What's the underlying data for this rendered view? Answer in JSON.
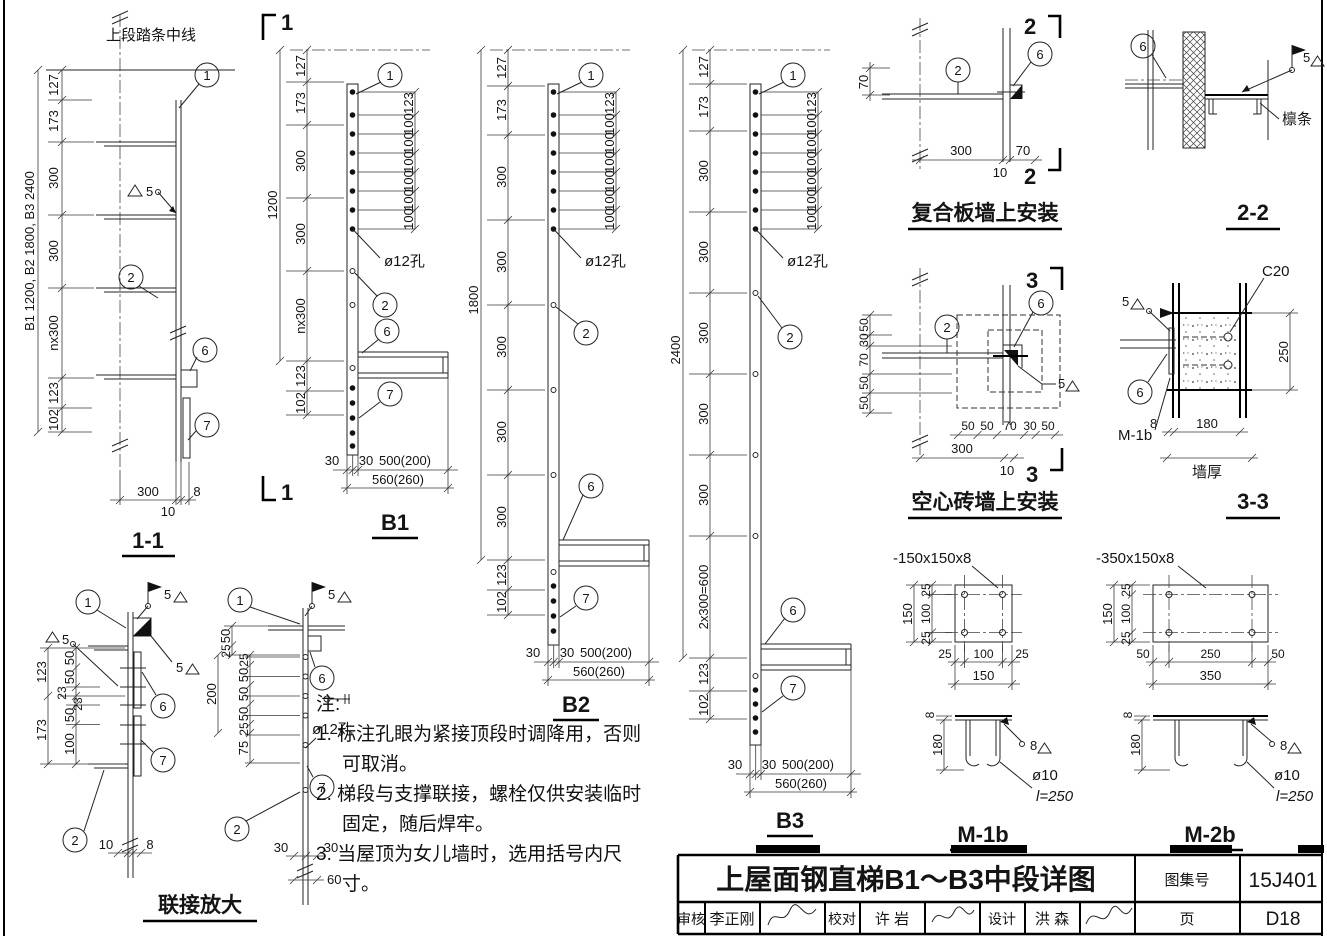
{
  "elevation": {
    "title": "1-1",
    "top_label": "上段踏条中线",
    "side_label": "B1 1200, B2 1800, B3 2400",
    "dims_left": [
      "127",
      "173",
      "300",
      "300",
      "nx300",
      "123",
      "102"
    ],
    "dims_bottom": [
      "300",
      "10",
      "8"
    ],
    "weld": "5",
    "callouts": {
      "c1": "1",
      "c2": "2",
      "c6": "6",
      "c7": "7"
    }
  },
  "b1": {
    "title": "B1",
    "cut_label": "1",
    "overall": "1200",
    "dims_left": [
      "127",
      "173",
      "300",
      "300",
      "nx300",
      "123",
      "102"
    ],
    "dims_right": [
      "123",
      "100",
      "100",
      "100",
      "100",
      "100",
      "100"
    ],
    "hole_label": "ø12孔",
    "dims_bottom": [
      "30",
      "30",
      "500(200)"
    ],
    "dim_total": "560(260)",
    "callouts": {
      "c1": "1",
      "c2": "2",
      "c6": "6",
      "c7": "7"
    }
  },
  "b2": {
    "title": "B2",
    "overall": "1800",
    "dims_left": [
      "127",
      "173",
      "300",
      "300",
      "300",
      "300",
      "300",
      "123",
      "102"
    ],
    "dims_right": [
      "123",
      "100",
      "100",
      "100",
      "100",
      "100",
      "100"
    ],
    "hole_label": "ø12孔",
    "dims_bottom": [
      "30",
      "30",
      "500(200)"
    ],
    "dim_total": "560(260)",
    "callouts": {
      "c1": "1",
      "c2": "2",
      "c6": "6",
      "c7": "7"
    }
  },
  "b3": {
    "title": "B3",
    "overall": "2400",
    "dims_left": [
      "127",
      "173",
      "300",
      "300",
      "300",
      "300",
      "300",
      "2x300=600",
      "123",
      "102"
    ],
    "dims_right": [
      "123",
      "100",
      "100",
      "100",
      "100",
      "100",
      "100"
    ],
    "hole_label": "ø12孔",
    "dims_bottom": [
      "30",
      "30",
      "500(200)"
    ],
    "dim_total": "560(260)",
    "callouts": {
      "c1": "1",
      "c2": "2",
      "c6": "6",
      "c7": "7"
    }
  },
  "composite": {
    "title": "复合板墙上安装",
    "cut_label": "2",
    "dim_offset": "70",
    "dims_bottom": [
      "300",
      "10",
      "70"
    ],
    "callouts": {
      "c2": "2",
      "c6": "6"
    }
  },
  "sec22": {
    "title": "2-2",
    "purlin_label": "檩条",
    "weld": "5",
    "callouts": {
      "c6": "6"
    }
  },
  "hollow": {
    "title": "空心砖墙上安装",
    "cut_label": "3",
    "dims_left": [
      "50",
      "30",
      "70",
      "50",
      "50"
    ],
    "dims_bottom": [
      "50",
      "50",
      "70",
      "30",
      "50"
    ],
    "dim_300": "300",
    "dim_10": "10",
    "weld": "5",
    "callouts": {
      "c2": "2",
      "c6": "6"
    }
  },
  "sec33": {
    "title": "3-3",
    "concrete_label": "C20",
    "dim_depth": "250",
    "bracket_label": "M-1b",
    "dim_plate": "8",
    "dim_wall": "180",
    "wall_label": "墙厚",
    "weld": "5",
    "callouts": {
      "c6": "6"
    }
  },
  "m1b": {
    "title": "M-1b",
    "plate_label": "-150x150x8",
    "dims_side": [
      "25",
      "100",
      "25"
    ],
    "dim_side_total": "150",
    "dims_bottom": [
      "25",
      "100",
      "25"
    ],
    "dim_bottom_total": "150",
    "dim_thickness": "8",
    "dim_embed": "180",
    "weld": "8",
    "anchor_dia": "ø10",
    "anchor_len": "l=250"
  },
  "m2b": {
    "title": "M-2b",
    "plate_label": "-350x150x8",
    "dims_side": [
      "25",
      "100",
      "25"
    ],
    "dim_side_total": "150",
    "dims_bottom": [
      "50",
      "250",
      "50"
    ],
    "dim_bottom_total": "350",
    "dim_thickness": "8",
    "dim_embed": "180",
    "weld": "8",
    "anchor_dia": "ø10",
    "anchor_len": "l=250"
  },
  "enlarge": {
    "title": "联接放大",
    "d1": {
      "dims_outer": [
        "123",
        "173"
      ],
      "dims_inner": [
        "50",
        "50",
        "23",
        "23",
        "50",
        "100"
      ],
      "dims_bottom": [
        "10",
        "8"
      ],
      "weld": "5",
      "callouts": {
        "c1": "1",
        "c2": "2",
        "c6": "6",
        "c7": "7"
      }
    },
    "d2": {
      "dims_top": [
        "50",
        "25"
      ],
      "overall": "200",
      "dims_inner": [
        "25",
        "50",
        "50",
        "50",
        "25"
      ],
      "dim_75": "75",
      "dims_bottom": [
        "30",
        "30",
        "60"
      ],
      "hole_label": "ø12孔",
      "weld": "5",
      "callouts": {
        "c1": "1",
        "c2": "2",
        "c6": "6",
        "c7": "7"
      }
    }
  },
  "notes": {
    "header": "注:",
    "items": [
      "1. 标注孔眼为紧接顶段时调降用，否则可取消。",
      "2. 梯段与支撑联接，螺栓仅供安装临时固定，随后焊牢。",
      "3. 当屋顶为女儿墙时，选用括号内尺寸。"
    ]
  },
  "titleblock": {
    "title": "上屋面钢直梯B1～B3中段详图",
    "atlas_label": "图集号",
    "atlas_no": "15J401",
    "page_label": "页",
    "page_no": "D18",
    "reviewer_label": "审核",
    "reviewer_name": "李正刚",
    "checker_label": "校对",
    "checker_name": "许 岩",
    "designer_label": "设计",
    "designer_name": "洪 森"
  }
}
